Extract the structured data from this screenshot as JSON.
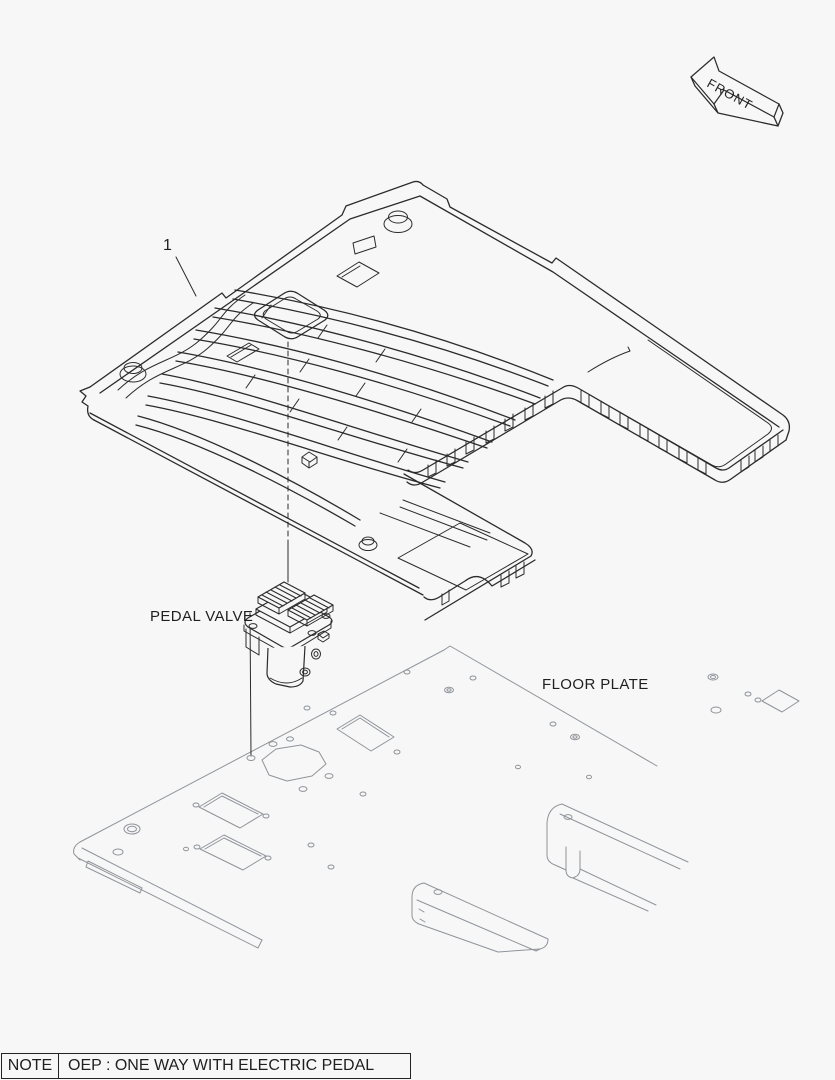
{
  "front_marker": {
    "label": "FRONT"
  },
  "callout": {
    "number": "1"
  },
  "labels": {
    "pedal_valve": "PEDAL VALVE",
    "floor_plate": "FLOOR PLATE"
  },
  "note": {
    "title": "NOTE",
    "text": "OEP : ONE WAY WITH ELECTRIC PEDAL"
  },
  "colors": {
    "background": "#f7f7f7",
    "line_dark": "#2b2b2b",
    "line_light": "#8f949a",
    "text": "#1f1f1f"
  }
}
